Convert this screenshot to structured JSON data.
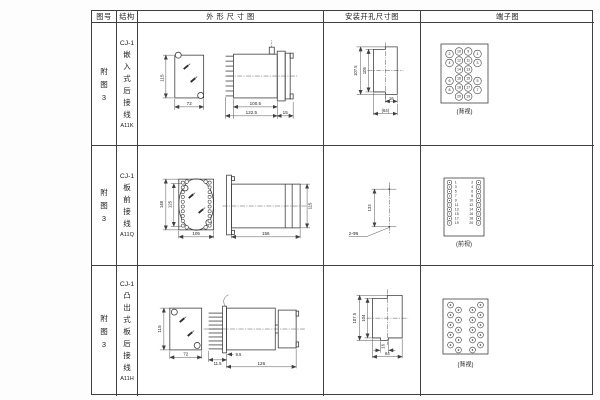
{
  "page": {
    "background": "#fdfdfd",
    "line_color": "#3f3f3f"
  },
  "table": {
    "headers": {
      "figure_no": "图号",
      "structure": "结构",
      "outline": "外 形 尺 寸 图",
      "mounting": "安装开孔尺寸图",
      "terminal": "端子图"
    },
    "rows": [
      {
        "figure_no": "附图3",
        "model": "CJ-1",
        "structure": "嵌入式后接线",
        "code": "A11K",
        "outline": {
          "height": "115",
          "width": "72",
          "body_len": "100.5",
          "total_len": "122.5",
          "flange": "15"
        },
        "mounting": {
          "outer_h": "107.5",
          "inner_h": "105",
          "notch_w": "16",
          "total_w": "(64)"
        },
        "terminal": {
          "view": "(背视)",
          "outer_left": [
            "2",
            "4",
            "6",
            "8"
          ],
          "mid_left": [
            "10",
            "12",
            "14",
            "16",
            "18",
            "20"
          ],
          "mid_right": [
            "9",
            "11",
            "13",
            "15",
            "17",
            "19"
          ],
          "outer_right": [
            "1",
            "3",
            "5",
            "7"
          ]
        }
      },
      {
        "figure_no": "附图3",
        "model": "CJ-1",
        "structure": "板前接线",
        "code": "A11Q",
        "outline": {
          "outer_h": "148",
          "inner_h": "125",
          "width": "105",
          "length": "156",
          "height": "115"
        },
        "mounting": {
          "pitch": "133",
          "holes": "2-Φ6"
        },
        "terminal": {
          "view": "(前视)",
          "left": [
            "1",
            "3",
            "5",
            "7",
            "9",
            "11",
            "13",
            "15",
            "17",
            "19"
          ],
          "right": [
            "2",
            "4",
            "6",
            "8",
            "10",
            "12",
            "14",
            "16",
            "18",
            "20"
          ]
        }
      },
      {
        "figure_no": "附图3",
        "model": "CJ-1",
        "structure": "凸出式板后接线",
        "code": "A11H",
        "outline": {
          "height": "115",
          "width": "72",
          "pin_len": "11.5",
          "offset": "9.5",
          "length": "126"
        },
        "mounting": {
          "outer_h": "107.5",
          "inner_h": "104",
          "notch_w": "16",
          "total_w": "64"
        },
        "terminal": {
          "view": "(背视)"
        }
      }
    ]
  }
}
